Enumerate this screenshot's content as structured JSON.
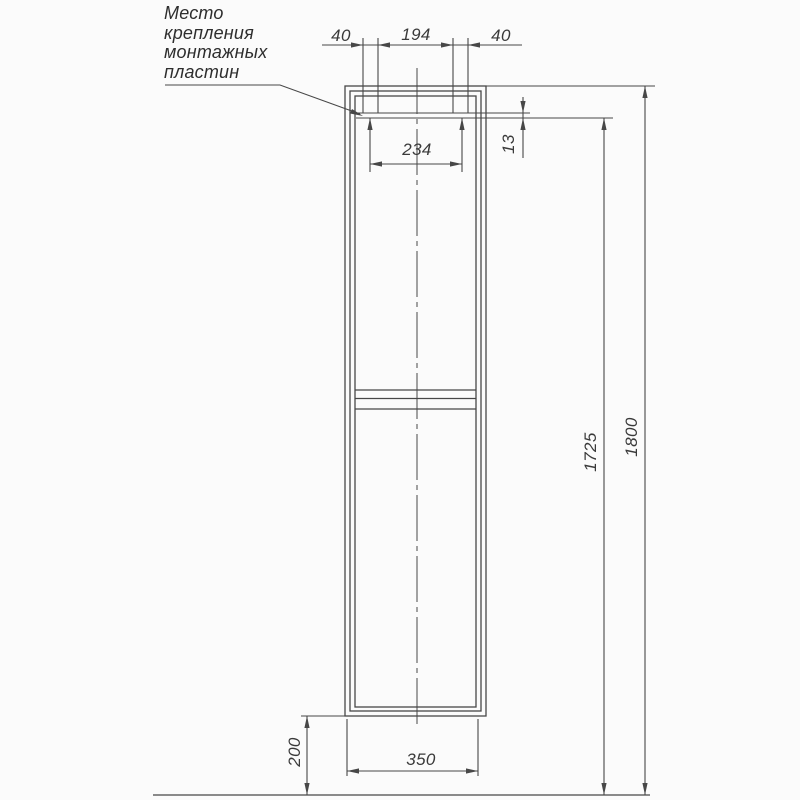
{
  "drawing": {
    "note": {
      "line1": "Место",
      "line2": "крепления",
      "line3": "монтажных",
      "line4": "пластин"
    },
    "dimensions": {
      "top_left_plate_width": "40",
      "top_plate_spacing": "194",
      "top_right_plate_width": "40",
      "plate_center_distance": "234",
      "plate_thickness": "13",
      "mounting_height": "1725",
      "total_height": "1800",
      "bottom_clearance": "200",
      "cabinet_width": "350"
    },
    "colors": {
      "line": "#474747",
      "text": "#3a3a3a",
      "background": "#fbfbfb"
    }
  }
}
